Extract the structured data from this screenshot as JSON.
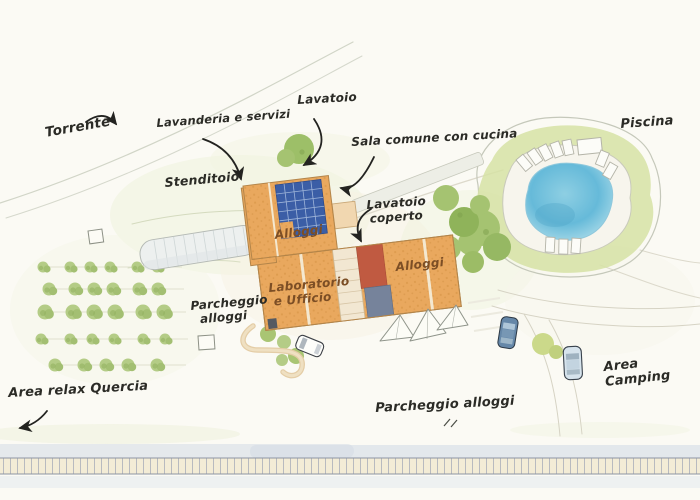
{
  "map_title": "Illustrated watercolor site plan (agriturismo / camping)",
  "palette": {
    "paper": "#fbfaf4",
    "ink": "#2b2b26",
    "label_brown": "#7c4e25",
    "roof_orange": "#e9a85e",
    "roof_outline": "#b3854a",
    "solar_blue": "#3b5ea6",
    "terracotta_red": "#c05a41",
    "slate_gray": "#76839b",
    "cream_tiles": "#f2e7d2",
    "grass_green": "#d6e2a4",
    "bush_green": "#b4cc86",
    "tree_green": "#a5c371",
    "pool_blue": "#66bad9",
    "deck_white": "#f7f5ed",
    "road_gray": "#d8d5c6",
    "water_wash_blue": "#d9e0e8"
  },
  "labels": [
    {
      "id": "torrente",
      "text": "Torrente",
      "x": 44,
      "y": 126,
      "rotate": -10,
      "size": 13.5,
      "color": "#2b2b26"
    },
    {
      "id": "lavanderia-e-servizi",
      "text": "Lavanderia e servizi",
      "x": 156,
      "y": 117,
      "rotate": -4,
      "size": 11.5,
      "color": "#2b2b26"
    },
    {
      "id": "lavatoio",
      "text": "Lavatoio",
      "x": 297,
      "y": 94,
      "rotate": -3,
      "size": 12,
      "color": "#2b2b26"
    },
    {
      "id": "sala-comune-con-cucina",
      "text": "Sala comune con cucina",
      "x": 351,
      "y": 136,
      "rotate": -3,
      "size": 12,
      "color": "#2b2b26"
    },
    {
      "id": "piscina",
      "text": "Piscina",
      "x": 620,
      "y": 118,
      "rotate": -4,
      "size": 13,
      "color": "#2b2b26"
    },
    {
      "id": "stenditoio",
      "text": "Stenditoio",
      "x": 164,
      "y": 176,
      "rotate": -5,
      "size": 12.5,
      "color": "#2b2b26"
    },
    {
      "id": "alloggi-nord",
      "text": "Alloggi",
      "x": 274,
      "y": 229,
      "rotate": -7,
      "size": 12,
      "color": "#7c4e25"
    },
    {
      "id": "lavatoio-coperto",
      "text": "Lavatoio\ncoperto",
      "x": 366,
      "y": 199,
      "rotate": -4,
      "size": 12,
      "color": "#2b2b26",
      "align": "center",
      "w": 58
    },
    {
      "id": "laboratorio-e-ufficio",
      "text": "Laboratorio\ne Ufficio",
      "x": 268,
      "y": 282,
      "rotate": -5,
      "size": 12,
      "color": "#7c4e25",
      "align": "center",
      "w": 66
    },
    {
      "id": "alloggi-est",
      "text": "Alloggi",
      "x": 395,
      "y": 261,
      "rotate": -6,
      "size": 12,
      "color": "#7c4e25"
    },
    {
      "id": "parcheggio-alloggi-ovest",
      "text": "Parcheggio\nalloggi",
      "x": 190,
      "y": 300,
      "rotate": -5,
      "size": 12,
      "color": "#2b2b26",
      "align": "center",
      "w": 64
    },
    {
      "id": "area-relax-quercia",
      "text": "Area relax Quercia",
      "x": 8,
      "y": 387,
      "rotate": -3,
      "size": 13,
      "color": "#2b2b26"
    },
    {
      "id": "area-camping",
      "text": "Area Camping",
      "x": 603,
      "y": 361,
      "rotate": -6,
      "size": 13,
      "color": "#2b2b26"
    },
    {
      "id": "parcheggio-alloggi-sud",
      "text": "Parcheggio alloggi",
      "x": 375,
      "y": 402,
      "rotate": -3,
      "size": 13,
      "color": "#2b2b26"
    }
  ]
}
